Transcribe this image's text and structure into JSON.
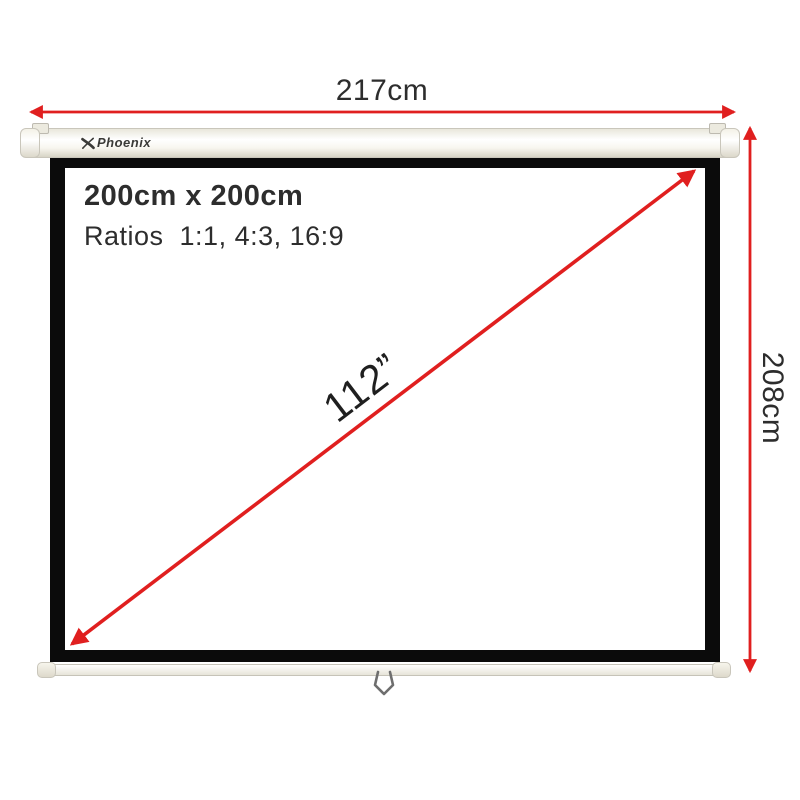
{
  "brand": {
    "name": "Phoenix"
  },
  "annotations": {
    "width_label": "217cm",
    "height_label": "208cm",
    "diagonal_label": "112”"
  },
  "screen": {
    "size_label": "200cm x 200cm",
    "ratios_label": "Ratios  1:1, 4:3, 16:9"
  },
  "colors": {
    "accent": "#e01f1f",
    "frame": "#0b0b0b",
    "text": "#2d2d2d",
    "logo": "#3b3b38",
    "tube-border": "#c9c6bb",
    "handle": "#6e6e6e"
  }
}
